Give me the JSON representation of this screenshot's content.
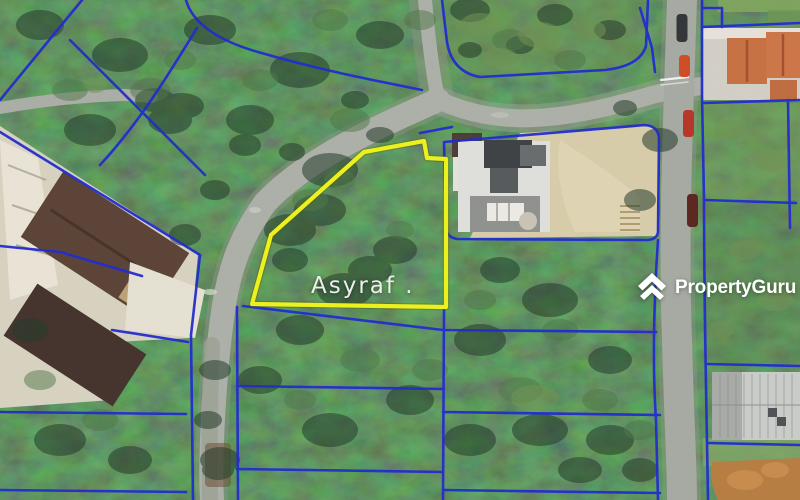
{
  "map": {
    "plot_label": "Asyraf .",
    "watermark_brand": "PropertyGuru",
    "colors": {
      "plot_outline_yellow": "#EEF218",
      "cadastral_blue": "#1E28CF",
      "label_white": "#EDEDED",
      "watermark_white": "#FFFFFF"
    }
  }
}
